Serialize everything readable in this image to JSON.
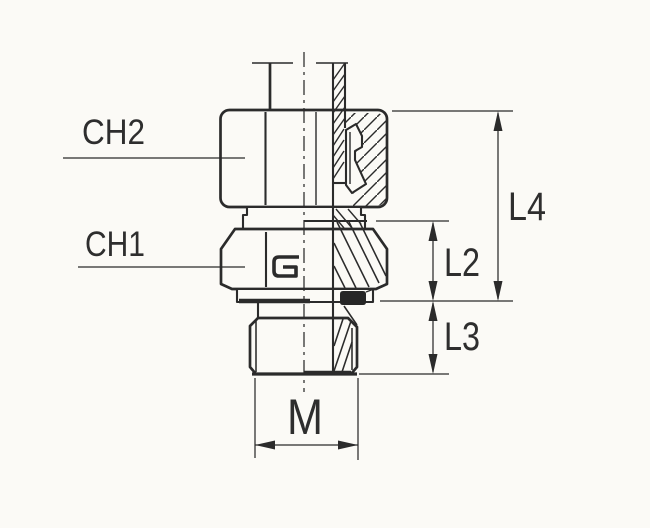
{
  "drawing": {
    "labels": {
      "ch2": "CH2",
      "ch1": "CH1",
      "l4": "L4",
      "l2": "L2",
      "l3": "L3",
      "m": "M"
    },
    "colors": {
      "ink": "#2b2b2b",
      "paper": "#fbfaf6",
      "seal_fill": "#262626"
    }
  }
}
